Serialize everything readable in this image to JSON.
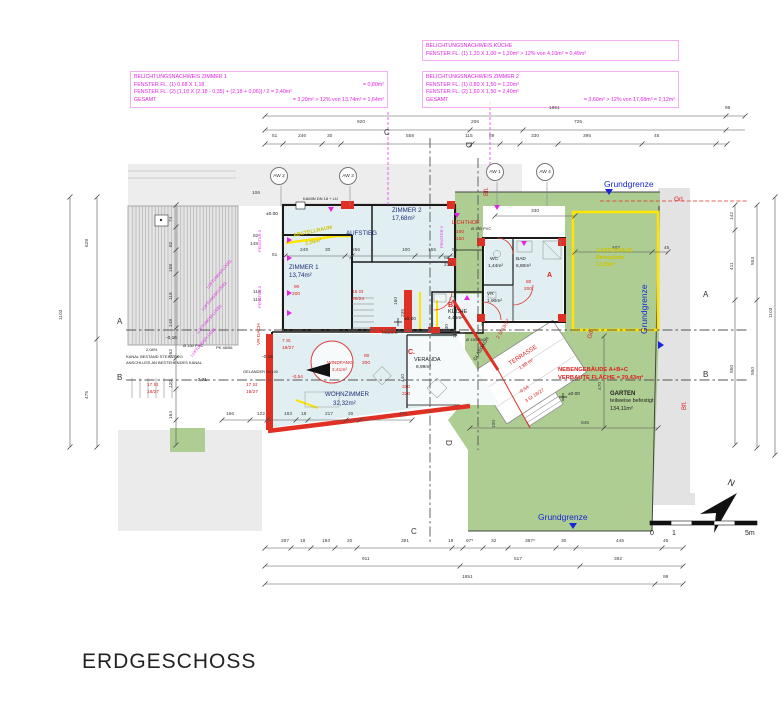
{
  "title": "ERDGESCHOSS",
  "belichtung_blocks": [
    {
      "lines": [
        {
          "l": "BELICHTUNGSNACHWEIS ZIMMER 1",
          "r": ""
        },
        {
          "l": "FENSTER FL. (1)  0,68 X 1,18",
          "r": "= 0,80m²"
        },
        {
          "l": "FENSTER FL. (2)  [1,18 X (2,18 - 0,35) + (2,18 + 0,06)] / 2 = 2,40m²",
          "r": ""
        },
        {
          "l": "GESAMT",
          "r": "= 3,20m² > 12% von 13,74m² = 1,64m²"
        }
      ]
    },
    {
      "lines": [
        {
          "l": "BELICHTUNGSNACHWEIS KÜCHE",
          "r": ""
        },
        {
          "l": "FENSTER FL. (1)  1,20 X 1,00 = 1,20m² > 12% von 4,10m² = 0,49m²",
          "r": ""
        }
      ]
    },
    {
      "lines": [
        {
          "l": "BELICHTUNGSNACHWEIS ZIMMER 2",
          "r": ""
        },
        {
          "l": "FENSTER FL. (1)  0,80 X 1,50 = 1,20m²",
          "r": ""
        },
        {
          "l": "FENSTER FL. (2)  1,60 X 1,50 = 2,40m²",
          "r": ""
        },
        {
          "l": "GESAMT",
          "r": "= 3,60m² > 12% von 17,68m² = 2,12m²"
        }
      ]
    }
  ],
  "aw_markers": [
    {
      "t": "AW 2",
      "s": "left:270px;top:167px"
    },
    {
      "t": "AW 3",
      "s": "left:339px;top:167px"
    },
    {
      "t": "AW 1",
      "s": "left:486px;top:163px"
    },
    {
      "t": "AW 4",
      "s": "left:536px;top:163px"
    }
  ],
  "labels": [
    {
      "t": "1851",
      "s": "left:549px;top:107px"
    },
    {
      "t": "99",
      "s": "left:725px;top:107px"
    },
    {
      "t": "920",
      "s": "left:357px;top:121px"
    },
    {
      "t": "206",
      "s": "left:471px;top:121px"
    },
    {
      "t": "725",
      "s": "left:574px;top:121px"
    },
    {
      "t": "51",
      "s": "left:272px;top:135px"
    },
    {
      "t": "246",
      "s": "left:298px;top:135px"
    },
    {
      "t": "30",
      "s": "left:327px;top:135px"
    },
    {
      "t": "558",
      "s": "left:406px;top:135px"
    },
    {
      "t": "115",
      "s": "left:465px;top:135px"
    },
    {
      "t": "89",
      "s": "left:489px;top:135px"
    },
    {
      "t": "330",
      "s": "left:531px;top:135px"
    },
    {
      "t": "395",
      "s": "left:583px;top:135px"
    },
    {
      "t": "45",
      "s": "left:654px;top:135px"
    },
    {
      "t": "106",
      "s": "left:252px;top:192px"
    },
    {
      "t": "249",
      "s": "left:300px;top:249px"
    },
    {
      "t": "30",
      "s": "left:325px;top:249px"
    },
    {
      "t": "256",
      "s": "left:352px;top:249px"
    },
    {
      "t": "100",
      "s": "left:402px;top:249px"
    },
    {
      "t": "155",
      "s": "left:428px;top:249px"
    },
    {
      "t": "51",
      "s": "left:452px;top:249px"
    },
    {
      "t": "60",
      "s": "left:444px;top:257px"
    },
    {
      "t": "210",
      "s": "left:444px;top:264px"
    },
    {
      "t": "330",
      "s": "left:531px;top:210px"
    },
    {
      "t": "407",
      "s": "left:612px;top:247px"
    },
    {
      "t": "45",
      "s": "left:664px;top:247px"
    },
    {
      "t": "287",
      "s": "left:281px;top:540px"
    },
    {
      "t": "18",
      "s": "left:300px;top:540px"
    },
    {
      "t": "193",
      "s": "left:322px;top:540px"
    },
    {
      "t": "20",
      "s": "left:347px;top:540px"
    },
    {
      "t": "381",
      "s": "left:401px;top:540px"
    },
    {
      "t": "18",
      "s": "left:448px;top:540px"
    },
    {
      "t": "97⁵",
      "s": "left:466px;top:540px"
    },
    {
      "t": "32",
      "s": "left:491px;top:540px"
    },
    {
      "t": "387⁵",
      "s": "left:525px;top:540px"
    },
    {
      "t": "30",
      "s": "left:561px;top:540px"
    },
    {
      "t": "445",
      "s": "left:616px;top:540px"
    },
    {
      "t": "45",
      "s": "left:663px;top:540px"
    },
    {
      "t": "911",
      "s": "left:362px;top:558px"
    },
    {
      "t": "517",
      "s": "left:514px;top:558px"
    },
    {
      "t": "392",
      "s": "left:614px;top:558px"
    },
    {
      "t": "1851",
      "s": "left:462px;top:576px"
    },
    {
      "t": "99",
      "s": "left:663px;top:576px"
    },
    {
      "t": "166",
      "s": "left:226px;top:413px"
    },
    {
      "t": "122",
      "s": "left:257px;top:413px"
    },
    {
      "t": "163",
      "s": "left:284px;top:413px"
    },
    {
      "t": "18",
      "s": "left:301px;top:413px"
    },
    {
      "t": "217",
      "s": "left:325px;top:413px"
    },
    {
      "t": "20",
      "s": "left:348px;top:413px"
    },
    {
      "t": "475",
      "s": "left:399px;top:413px"
    },
    {
      "t": "845",
      "s": "left:581px;top:422px"
    },
    {
      "t": "1103",
      "s": "left:60px;top:320px;transform:rotate(-90deg)"
    },
    {
      "t": "628",
      "s": "left:86px;top:247px;transform:rotate(-90deg)"
    },
    {
      "t": "475",
      "s": "left:86px;top:399px;transform:rotate(-90deg)"
    },
    {
      "t": "74",
      "s": "left:170px;top:222px;transform:rotate(-90deg)"
    },
    {
      "t": "82",
      "s": "left:170px;top:247px;transform:rotate(-90deg)"
    },
    {
      "t": "158",
      "s": "left:170px;top:272px;transform:rotate(-90deg)"
    },
    {
      "t": "118",
      "s": "left:170px;top:300px;transform:rotate(-90deg)"
    },
    {
      "t": "148",
      "s": "left:170px;top:327px;transform:rotate(-90deg)"
    },
    {
      "t": "162",
      "s": "left:170px;top:357px;transform:rotate(-90deg)"
    },
    {
      "t": "120",
      "s": "left:170px;top:388px;transform:rotate(-90deg)"
    },
    {
      "t": "164",
      "s": "left:170px;top:419px;transform:rotate(-90deg)"
    },
    {
      "t": "82",
      "s": "left:253px;top:235px"
    },
    {
      "t": "148",
      "s": "left:250px;top:243px"
    },
    {
      "t": "51",
      "s": "left:272px;top:254px"
    },
    {
      "t": "118",
      "s": "left:253px;top:291px"
    },
    {
      "t": "118",
      "s": "left:253px;top:299px"
    },
    {
      "t": "142",
      "s": "left:731px;top:220px;transform:rotate(-90deg)"
    },
    {
      "t": "411",
      "s": "left:731px;top:270px;transform:rotate(-90deg)"
    },
    {
      "t": "550",
      "s": "left:731px;top:373px;transform:rotate(-90deg)"
    },
    {
      "t": "553",
      "s": "left:752px;top:265px;transform:rotate(-90deg)"
    },
    {
      "t": "550",
      "s": "left:752px;top:375px;transform:rotate(-90deg)"
    },
    {
      "t": "1103",
      "s": "left:770px;top:318px;transform:rotate(-90deg)"
    },
    {
      "t": "470",
      "s": "left:599px;top:390px;transform:rotate(-90deg)"
    },
    {
      "t": "100",
      "s": "left:493px;top:428px;transform:rotate(-90deg)"
    },
    {
      "t": "130",
      "s": "left:446px;top:332px;transform:rotate(-90deg)"
    },
    {
      "t": "110",
      "s": "left:454px;top:338px;transform:rotate(-90deg)"
    },
    {
      "t": "235",
      "s": "left:402px;top:317px;transform:rotate(-90deg)"
    },
    {
      "t": "440",
      "s": "left:402px;top:382px;transform:rotate(-90deg)"
    },
    {
      "t": "160",
      "s": "left:395px;top:305px;transform:rotate(-90deg)"
    },
    {
      "t": "310",
      "s": "left:402px;top:386px",
      "c": "r"
    },
    {
      "t": "220",
      "s": "left:402px;top:393px",
      "c": "r"
    },
    {
      "t": "A",
      "s": "left:117px;top:318px",
      "c": "sec"
    },
    {
      "t": "B",
      "s": "left:117px;top:374px",
      "c": "sec"
    },
    {
      "t": "A",
      "s": "left:703px;top:291px",
      "c": "sec"
    },
    {
      "t": "B",
      "s": "left:703px;top:371px",
      "c": "sec"
    },
    {
      "t": "C",
      "s": "left:384px;top:129px",
      "c": "sec"
    },
    {
      "t": "C",
      "s": "left:411px;top:528px",
      "c": "sec"
    },
    {
      "t": "D",
      "s": "left:472px;top:142px;transform:rotate(90deg)",
      "c": "sec"
    },
    {
      "t": "D",
      "s": "left:452px;top:440px;transform:rotate(90deg)",
      "c": "sec"
    },
    {
      "t": "Grundgrenze",
      "s": "left:604px;top:180px",
      "c": "b"
    },
    {
      "t": "Grundgrenze",
      "s": "left:640px;top:334px;transform:rotate(-90deg)",
      "c": "b"
    },
    {
      "t": "Grundgrenze",
      "s": "left:538px;top:513px",
      "c": "b"
    },
    {
      "t": "Grl.",
      "s": "left:674px;top:197px;font-size:6.5px",
      "c": "r"
    },
    {
      "t": "Gd.",
      "s": "left:587px;top:338px;transform:rotate(-75deg);font-size:6px",
      "c": "r"
    },
    {
      "t": "Bfl.",
      "s": "left:484px;top:196px;transform:rotate(-90deg);font-size:6px",
      "c": "r"
    },
    {
      "t": "Bfl.",
      "s": "left:682px;top:410px;transform:rotate(-90deg);font-size:6px",
      "c": "r"
    },
    {
      "t": "ZIMMER 1",
      "s": "left:289px;top:265px",
      "c": "n"
    },
    {
      "t": "13,74m²",
      "s": "left:289px;top:273px",
      "c": "n"
    },
    {
      "t": "ZIMMER 2",
      "s": "left:392px;top:208px",
      "c": "n"
    },
    {
      "t": "17,68m²",
      "s": "left:392px;top:216px",
      "c": "n"
    },
    {
      "t": "AUFSTIEG",
      "s": "left:346px;top:231px",
      "c": "n"
    },
    {
      "t": "WOHNZIMMER",
      "s": "left:325px;top:392px",
      "c": "n"
    },
    {
      "t": "32,32m²",
      "s": "left:333px;top:401px",
      "c": "n"
    },
    {
      "t": "WC",
      "s": "left:490px;top:258px",
      "c": "k"
    },
    {
      "t": "1,44m²",
      "s": "left:488px;top:265px",
      "c": "k"
    },
    {
      "t": "BAD",
      "s": "left:516px;top:258px",
      "c": "k"
    },
    {
      "t": "6,80m²",
      "s": "left:516px;top:265px",
      "c": "k"
    },
    {
      "t": "VR",
      "s": "left:487px;top:293px",
      "c": "k"
    },
    {
      "t": "1,90m²",
      "s": "left:487px;top:300px",
      "c": "k"
    },
    {
      "t": "B.",
      "s": "left:448px;top:302px",
      "c": "r f7"
    },
    {
      "t": "KÜCHE",
      "s": "left:448px;top:310px",
      "c": "k f55"
    },
    {
      "t": "4,45m²",
      "s": "left:448px;top:317px",
      "c": "k"
    },
    {
      "t": "C.",
      "s": "left:408px;top:349px",
      "c": "r f7"
    },
    {
      "t": "VERANDA",
      "s": "left:414px;top:358px",
      "c": "k f55"
    },
    {
      "t": "8,99m²",
      "s": "left:416px;top:366px",
      "c": "k"
    },
    {
      "t": "A",
      "s": "left:547px;top:272px",
      "c": "r f7"
    },
    {
      "t": "WINDFANG",
      "s": "left:327px;top:362px",
      "c": "r"
    },
    {
      "t": "2,41m²",
      "s": "left:332px;top:369px",
      "c": "r"
    },
    {
      "t": "TERRASSE",
      "s": "left:508px;top:362px;transform:rotate(-33deg);font-size:6px",
      "c": "r"
    },
    {
      "t": "1,88 m²",
      "s": "left:519px;top:368px;transform:rotate(-33deg)",
      "c": "r"
    },
    {
      "t": "GLASDACH",
      "s": "left:474px;top:360px;transform:rotate(-60deg)",
      "c": "k"
    },
    {
      "t": "LICHTHOF",
      "s": "left:452px;top:221px",
      "c": "r f55"
    },
    {
      "t": "160",
      "s": "left:456px;top:231px",
      "c": "r"
    },
    {
      "t": "150",
      "s": "left:456px;top:238px",
      "c": "r"
    },
    {
      "t": "GARTENHAUS",
      "s": "left:596px;top:249px",
      "c": "y"
    },
    {
      "t": "Betonplatte",
      "s": "left:596px;top:256px",
      "c": "y"
    },
    {
      "t": "12,28m²",
      "s": "left:596px;top:263px",
      "c": "y"
    },
    {
      "t": "NEBENGEBÄUDE A+B+C",
      "s": "left:558px;top:368px;font-size:5.8px;font-weight:bold",
      "c": "r"
    },
    {
      "t": "VERBAUTE FLÄCHE = 29,43m²",
      "s": "left:558px;top:376px;font-size:5.8px;font-weight:bold",
      "c": "r"
    },
    {
      "t": "GARTEN",
      "s": "left:610px;top:391px;font-size:6px;font-weight:bold",
      "c": "k"
    },
    {
      "t": "teilweise befestigt",
      "s": "left:610px;top:399px;font-size:5.5px",
      "c": "k"
    },
    {
      "t": "134,11m²",
      "s": "left:610px;top:407px;font-size:5.5px",
      "c": "k"
    },
    {
      "t": "±0.00",
      "s": "left:404px;top:318px",
      "c": "k"
    },
    {
      "t": "±0.00",
      "s": "left:568px;top:393px",
      "c": "k"
    },
    {
      "t": "±0.00",
      "s": "left:266px;top:213px",
      "c": "k"
    },
    {
      "t": "-0,16",
      "s": "left:262px;top:356px",
      "c": "k"
    },
    {
      "t": "-0,16",
      "s": "left:166px;top:337px",
      "c": "k"
    },
    {
      "t": "-3,71",
      "s": "left:196px;top:379px",
      "c": "k"
    },
    {
      "t": "-0,54",
      "s": "left:292px;top:376px",
      "c": "r"
    },
    {
      "t": "-0,54",
      "s": "left:519px;top:392px;transform:rotate(-33deg)",
      "c": "r"
    },
    {
      "t": "3 St 18/27",
      "s": "left:525px;top:401px;transform:rotate(-33deg)",
      "c": "r"
    },
    {
      "t": "17 St",
      "s": "left:147px;top:384px",
      "c": "r"
    },
    {
      "t": "18/27",
      "s": "left:147px;top:391px",
      "c": "r"
    },
    {
      "t": "17 St",
      "s": "left:246px;top:384px",
      "c": "r"
    },
    {
      "t": "18/27",
      "s": "left:246px;top:391px",
      "c": "r"
    },
    {
      "t": "7 St",
      "s": "left:282px;top:340px",
      "c": "r"
    },
    {
      "t": "19/27",
      "s": "left:282px;top:347px",
      "c": "r"
    },
    {
      "t": "15 St",
      "s": "left:352px;top:291px",
      "c": "r"
    },
    {
      "t": "20/24",
      "s": "left:352px;top:298px",
      "c": "r"
    },
    {
      "t": "2 St 18/27",
      "s": "left:497px;top:338px;transform:rotate(-60deg)",
      "c": "r"
    },
    {
      "t": "90",
      "s": "left:294px;top:286px",
      "c": "r"
    },
    {
      "t": "200",
      "s": "left:292px;top:293px",
      "c": "r"
    },
    {
      "t": "80",
      "s": "left:364px;top:355px",
      "c": "r"
    },
    {
      "t": "200",
      "s": "left:362px;top:362px",
      "c": "r"
    },
    {
      "t": "80",
      "s": "left:526px;top:281px",
      "c": "r"
    },
    {
      "t": "200",
      "s": "left:524px;top:288px",
      "c": "r"
    },
    {
      "t": "GELÄNDER H=100",
      "s": "left:243px;top:370px",
      "c": "k f4"
    },
    {
      "t": "KANAL BESTAND STEINZEUG",
      "s": "left:126px;top:355px",
      "c": "k f4"
    },
    {
      "t": "ANSCHLUSS AN BESTEHENDES KANAL",
      "s": "left:126px;top:361px",
      "c": "k f4"
    },
    {
      "t": "2,08%",
      "s": "left:146px;top:348px",
      "c": "k f4"
    },
    {
      "t": "Ø 150 PVC",
      "s": "left:183px;top:344px",
      "c": "k f4"
    },
    {
      "t": "PK 48/56",
      "s": "left:216px;top:346px",
      "c": "k f4"
    },
    {
      "t": "Ø 150 PVC",
      "s": "left:466px;top:338px",
      "c": "k f4"
    },
    {
      "t": "Ø 150 PVC",
      "s": "left:471px;top:227px",
      "c": "k f4"
    },
    {
      "t": "KAMIN DN 18 + LÜ",
      "s": "left:303px;top:197px",
      "c": "k f4"
    },
    {
      "t": "TRÄGER",
      "s": "left:381px;top:331px",
      "c": "k f4"
    },
    {
      "t": "ABSTELLRAUM",
      "s": "left:293px;top:234px;transform:rotate(-12deg)",
      "c": "y"
    },
    {
      "t": "2,56m²",
      "s": "left:305px;top:242px;transform:rotate(-12deg)",
      "c": "y"
    },
    {
      "t": "LÜFTUNGSFLÜGEL",
      "s": "left:206px;top:287px;transform:rotate(-50deg)",
      "c": "m f4"
    },
    {
      "t": "LÜFTUNGSFLÜGEL",
      "s": "left:201px;top:309px;transform:rotate(-50deg)",
      "c": "m f4"
    },
    {
      "t": "LÜFTUNGSFLÜGEL",
      "s": "left:196px;top:332px;transform:rotate(-50deg)",
      "c": "m f4"
    },
    {
      "t": "LÜFTUNGSFLÜGEL",
      "s": "left:190px;top:355px;transform:rotate(-50deg)",
      "c": "m f4"
    },
    {
      "t": "FENSTER 3",
      "s": "left:258px;top:252px;transform:rotate(-90deg)",
      "c": "m f4"
    },
    {
      "t": "FENSTER 3",
      "s": "left:258px;top:308px;transform:rotate(-90deg)",
      "c": "m f4"
    },
    {
      "t": "FENSTER 2",
      "s": "left:440px;top:248px;transform:rotate(-90deg)",
      "c": "m f4"
    },
    {
      "t": "VR DACH",
      "s": "left:258px;top:345px;transform:rotate(-90deg)",
      "c": "r"
    },
    {
      "t": "N",
      "s": "left:729px;top:478px;font-size:9px;font-style:italic;transform:rotate(15deg)",
      "c": "k"
    },
    {
      "t": "0",
      "s": "left:650px;top:530px;font-size:7px",
      "c": "k"
    },
    {
      "t": "1",
      "s": "left:672px;top:530px;font-size:7px",
      "c": "k"
    },
    {
      "t": "5m",
      "s": "left:745px;top:530px;font-size:7px",
      "c": "k"
    }
  ]
}
